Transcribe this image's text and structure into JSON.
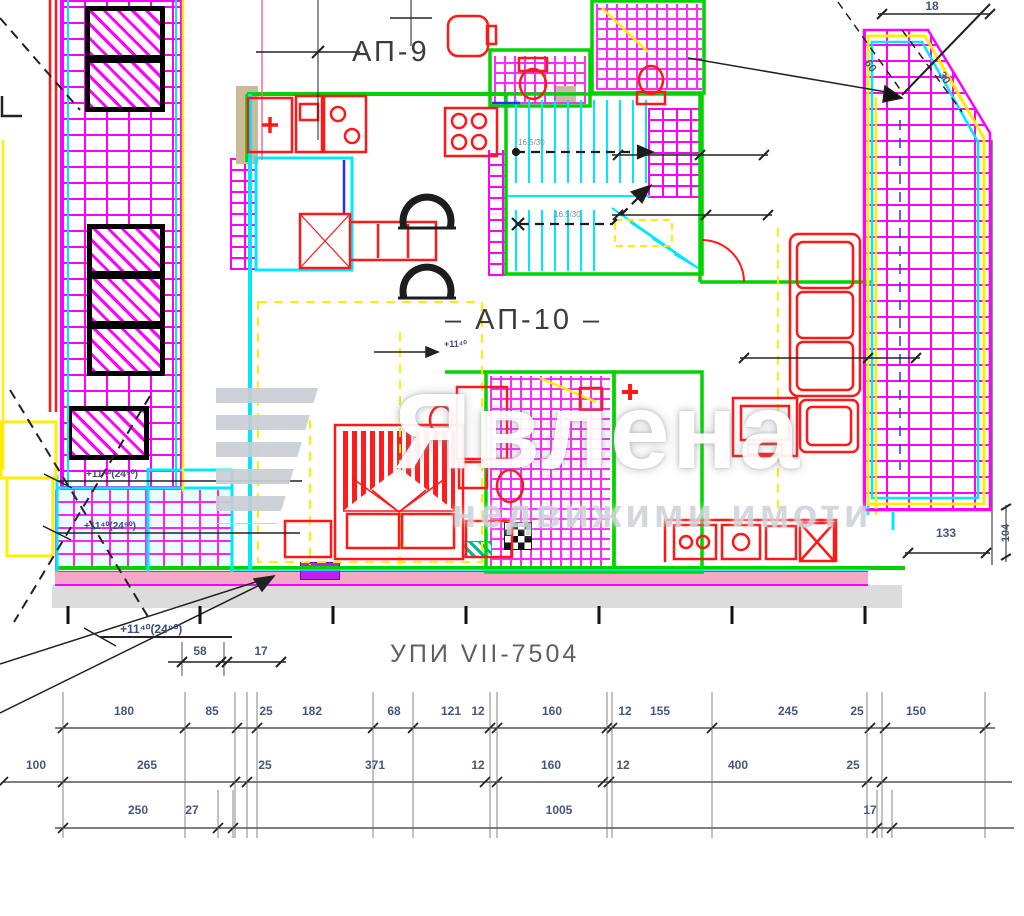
{
  "drawing": {
    "labels": {
      "ap9": "АП-9",
      "ap10": "– АП-10 –",
      "site": "УПИ  VII-7504"
    },
    "levels": {
      "bottom_left": "+11⁴⁰(24⁹⁰)",
      "wall_upper": "+11⁴⁰(24⁹⁰)",
      "wall_lower": "+11⁴⁰(24⁹⁰)",
      "room": "+11⁴⁰"
    },
    "stairs": {
      "note_up": "16.5/30",
      "note_down": "16.5/30"
    },
    "dims": {
      "row1": [
        "180",
        "85",
        "25",
        "182",
        "68",
        "121",
        "12",
        "160",
        "12",
        "155",
        "245",
        "25",
        "150"
      ],
      "row2": [
        "100",
        "265",
        "25",
        "371",
        "12",
        "160",
        "12",
        "400",
        "25"
      ],
      "row3": [
        "250",
        "27",
        "1005",
        "17"
      ],
      "small_left": [
        "58",
        "17"
      ],
      "right_width": "133",
      "right_height": "104",
      "top_right": {
        "width": "18",
        "diag_a": "60",
        "diag_b": "30"
      }
    }
  },
  "watermark": {
    "brand": "Явлена",
    "tagline": "недвижими имоти"
  },
  "colors": {
    "wall_hatch": "#ff00ff",
    "line_cyan": "#00e8ff",
    "line_yellow": "#ffee00",
    "line_green": "#00d400",
    "furniture_red": "#ff1818",
    "dim_text": "#45577f",
    "pavement": "#dcdcdc",
    "balcony_band": "#f3a8c6"
  }
}
